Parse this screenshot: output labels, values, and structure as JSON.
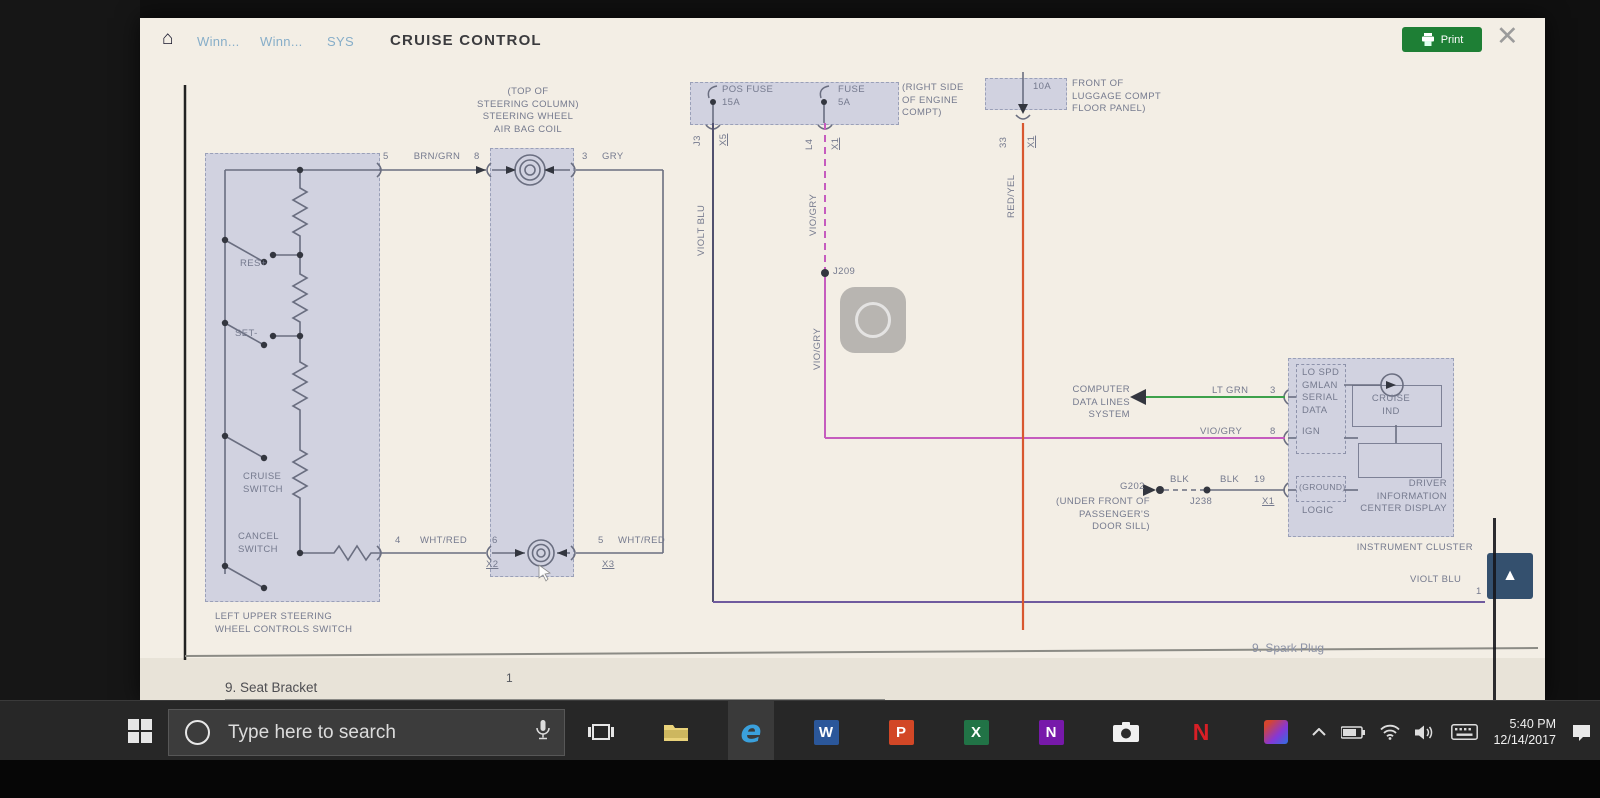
{
  "header": {
    "home_icon": "⌂",
    "breadcrumbs": [
      "Winn...",
      "Winn...",
      "SYS"
    ],
    "title": "CRUISE CONTROL",
    "print_label": "Print",
    "close_icon": "✕"
  },
  "diagram": {
    "switch_assembly": {
      "res": "RES+",
      "set": "SET-",
      "cruise": "CRUISE\nSWITCH",
      "cancel": "CANCEL\nSWITCH",
      "caption": "LEFT UPPER STEERING\nWHEEL CONTROLS SWITCH"
    },
    "airbag_coil_label": "(TOP OF\nSTEERING COLUMN)\nSTEERING WHEEL\nAIR BAG COIL",
    "fuse_block": {
      "fuse1": "POS FUSE\n15A",
      "fuse2": "FUSE\n5A",
      "location": "(RIGHT SIDE\nOF ENGINE\nCOMPT)",
      "conn1_a": "J3",
      "conn1_b": "X5",
      "conn2_a": "L4",
      "conn2_b": "X1"
    },
    "luggage_fuse": {
      "amps": "10A",
      "location": "FRONT OF\nLUGGAGE COMPT\nFLOOR PANEL)",
      "conn_a": "33",
      "conn_b": "X1",
      "wire": "RED/YEL"
    },
    "wires": {
      "pin5a": "5",
      "brn_grn": "BRN/GRN",
      "pin8a": "8",
      "pin3a": "3",
      "gry": "GRY",
      "pin4": "4",
      "wht_red_l": "WHT/RED",
      "pin6": "6",
      "conn_x2": "X2",
      "pin5b": "5",
      "wht_red_r": "WHT/RED",
      "conn_x3": "X3",
      "violt_blu_vert": "VIOLT BLU",
      "vio_gry_vert1": "VIO/GRY",
      "vio_gry_vert2": "VIO/GRY",
      "splice1": "J209",
      "lt_grn": "LT GRN",
      "pin3b": "3",
      "vio_gry_h": "VIO/GRY",
      "pin8b": "8",
      "blk_a": "BLK",
      "blk_b": "BLK",
      "pin19": "19",
      "conn_x1": "X1",
      "ground_id": "G202",
      "splice2": "J238",
      "ground_loc": "(UNDER FRONT OF\nPASSENGER'S\nDOOR SILL)",
      "violt_blu_bot": "VIOLT BLU",
      "pin1": "1"
    },
    "computer_data": "COMPUTER\nDATA LINES\nSYSTEM",
    "cluster": {
      "serial": "LO SPD\nGMLAN\nSERIAL\nDATA",
      "ign": "IGN",
      "cruise_ind": "CRUISE\nIND",
      "ground": "(GROUND)",
      "logic": "LOGIC",
      "dic": "DRIVER\nINFORMATION\nCENTER DISPLAY",
      "caption": "INSTRUMENT CLUSTER"
    },
    "page_number": "1",
    "underlay_left": "9. Seat Bracket",
    "underlay_right": "9. Spark Plug",
    "scroll_up_icon": "▲"
  },
  "taskbar": {
    "search_text": "Type here to search",
    "tray_time": "5:40 PM",
    "tray_date": "12/14/2017"
  },
  "colors": {
    "print_green": "#1e7f35",
    "lavender": "#c4cae2",
    "wire_magenta": "#c55cbe",
    "wire_green": "#3da14b",
    "wire_orange": "#d8572f",
    "wire_purple": "#6f5a9e",
    "scroll_button_blue": "#34506e"
  }
}
